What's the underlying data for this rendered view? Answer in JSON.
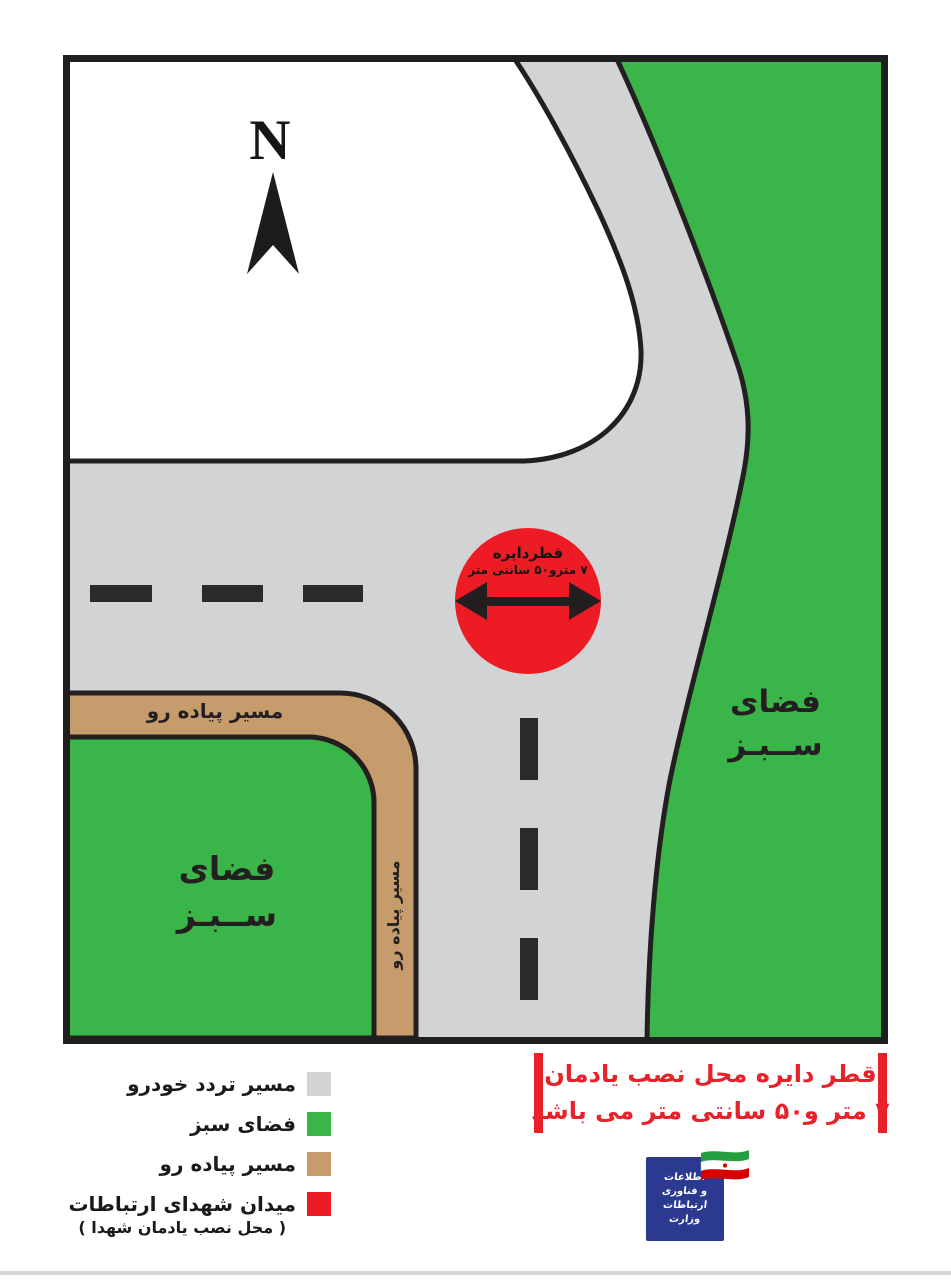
{
  "map": {
    "north_label": "N",
    "colors": {
      "road": "#d2d3d5",
      "green_space": "#3ab54a",
      "sidewalk": "#c69c6d",
      "outline": "#231f20",
      "marker_circle": "#ed1c24",
      "lane_dash": "#2b2a29",
      "white_area": "#ffffff"
    },
    "circle_label": {
      "line1": "قطردایره",
      "line2": "۷ مترو۵۰ سانتی متر"
    },
    "green_right_label": {
      "line1": "فضای",
      "line2": "ســبـز"
    },
    "green_left_label": {
      "line1": "فضای",
      "line2": "ســبـز"
    },
    "sidewalk_top_label": "مسیر پیاده رو",
    "sidewalk_side_label": "مسیر پیاده رو"
  },
  "legend": {
    "items": [
      {
        "label": "مسیر تردد خودرو",
        "color": "#d2d3d5"
      },
      {
        "label": "فضای سبز",
        "color": "#3ab54a"
      },
      {
        "label": "مسیر پیاده رو",
        "color": "#c69c6d"
      },
      {
        "label": "میدان شهدای ارتباطات",
        "sublabel": "( محل نصب یادمان شهدا )",
        "color": "#ed1c24"
      }
    ]
  },
  "note": {
    "line1": "قطر دایره محل نصب یادمان",
    "line2": "۷ متر و۵۰ سانتی متر می باشد",
    "accent_color": "#e8222a"
  },
  "logo": {
    "lines": [
      "اطلاعات",
      "و فناوری",
      "ارتباطات",
      "وزارت"
    ],
    "bg_color": "#2b3990",
    "flag_colors": {
      "green": "#239f40",
      "white": "#ffffff",
      "red": "#da0000"
    }
  }
}
